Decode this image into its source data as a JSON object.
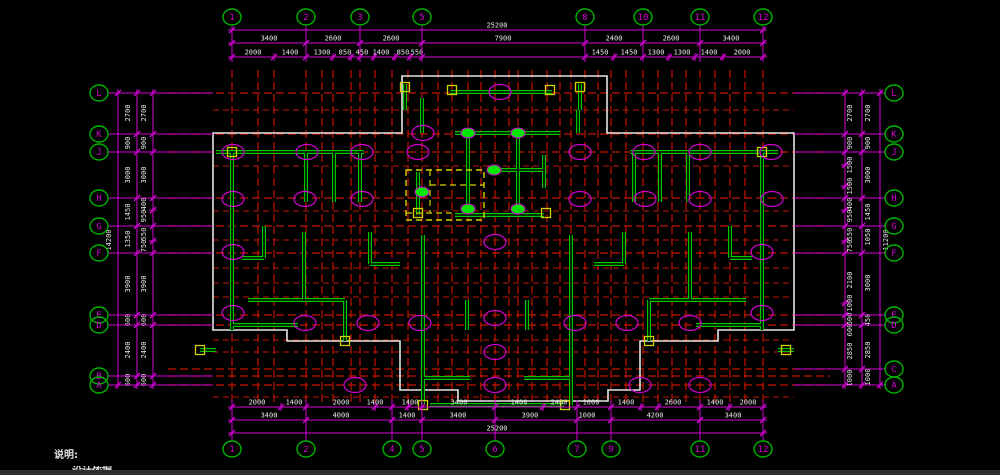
{
  "meta": {
    "app_area": "cad-structural-plan-viewport",
    "background": "#000000",
    "statusbar_color": "#2e2e2e"
  },
  "colors": {
    "grid_red": "#c21500",
    "dim_magenta": "#d400d4",
    "bubble_green": "#00b400",
    "bubble_text": "#d400d4",
    "wall_green": "#00c800",
    "outline_white": "#e6e6e6",
    "yellow": "#d2d200",
    "dot_green": "#00e600",
    "dim_text": "#e8e8e8"
  },
  "notes": {
    "title": "说明:",
    "line2": "设计依据"
  },
  "bubbles": {
    "top_y": 17,
    "bottom_y": 449,
    "left_x": 99,
    "right_x": 894,
    "top": [
      {
        "label": "1",
        "x": 232
      },
      {
        "label": "2",
        "x": 306
      },
      {
        "label": "3",
        "x": 360
      },
      {
        "label": "5",
        "x": 422
      },
      {
        "label": "8",
        "x": 585
      },
      {
        "label": "10",
        "x": 643
      },
      {
        "label": "11",
        "x": 700
      },
      {
        "label": "12",
        "x": 763
      }
    ],
    "bottom": [
      {
        "label": "1",
        "x": 232
      },
      {
        "label": "2",
        "x": 306
      },
      {
        "label": "4",
        "x": 392
      },
      {
        "label": "5",
        "x": 422
      },
      {
        "label": "6",
        "x": 495
      },
      {
        "label": "7",
        "x": 577
      },
      {
        "label": "9",
        "x": 611
      },
      {
        "label": "11",
        "x": 700
      },
      {
        "label": "12",
        "x": 763
      }
    ],
    "left": [
      {
        "label": "L",
        "y": 93
      },
      {
        "label": "K",
        "y": 134
      },
      {
        "label": "J",
        "y": 152
      },
      {
        "label": "H",
        "y": 198
      },
      {
        "label": "G",
        "y": 226
      },
      {
        "label": "F",
        "y": 253
      },
      {
        "label": "E",
        "y": 315
      },
      {
        "label": "D",
        "y": 325
      },
      {
        "label": "B",
        "y": 376
      },
      {
        "label": "A",
        "y": 385
      }
    ],
    "right": [
      {
        "label": "L",
        "y": 93
      },
      {
        "label": "K",
        "y": 134
      },
      {
        "label": "J",
        "y": 152
      },
      {
        "label": "H",
        "y": 198
      },
      {
        "label": "G",
        "y": 226
      },
      {
        "label": "F",
        "y": 253
      },
      {
        "label": "E",
        "y": 315
      },
      {
        "label": "D",
        "y": 325
      },
      {
        "label": "C",
        "y": 369
      },
      {
        "label": "A",
        "y": 385
      }
    ]
  },
  "dims": {
    "top_rows": [
      {
        "y": 30,
        "x1": 232,
        "x2": 763,
        "ticks": [
          232,
          763
        ],
        "labels": [
          [
            "25200",
            497
          ]
        ]
      },
      {
        "y": 43,
        "x1": 232,
        "x2": 763,
        "ticks": [
          232,
          306,
          360,
          422,
          585,
          643,
          700,
          763
        ],
        "labels": [
          [
            "3400",
            269
          ],
          [
            "2600",
            333
          ],
          [
            "2600",
            391
          ],
          [
            "7900",
            503
          ],
          [
            "2400",
            614
          ],
          [
            "2600",
            671
          ],
          [
            "3400",
            731
          ]
        ]
      },
      {
        "y": 57,
        "x1": 232,
        "x2": 763,
        "ticks": [
          232,
          274,
          306,
          333,
          351,
          360,
          374,
          395,
          410,
          422,
          585,
          614,
          643,
          669,
          695,
          723,
          763
        ],
        "labels": [
          [
            "2000",
            253
          ],
          [
            "1400",
            290
          ],
          [
            "1300",
            322
          ],
          [
            "850",
            345
          ],
          [
            "450",
            362
          ],
          [
            "1400",
            381
          ],
          [
            "850",
            403
          ],
          [
            "550",
            417
          ],
          [
            "1450",
            600
          ],
          [
            "1450",
            629
          ],
          [
            "1300",
            656
          ],
          [
            "1300",
            682
          ],
          [
            "1400",
            709
          ],
          [
            "2000",
            742
          ]
        ]
      }
    ],
    "bottom_rows": [
      {
        "y": 407,
        "x1": 232,
        "x2": 763,
        "ticks": [
          232,
          281,
          306,
          375,
          392,
          408,
          422,
          495,
          543,
          577,
          611,
          641,
          658,
          700,
          729,
          763
        ],
        "labels": [
          [
            "2000",
            257
          ],
          [
            "1400",
            294
          ],
          [
            "2000",
            341
          ],
          [
            "1400",
            375
          ],
          [
            "1400",
            410
          ],
          [
            "3400",
            459
          ],
          [
            "1400",
            519
          ],
          [
            "2400",
            559
          ],
          [
            "1000",
            591
          ],
          [
            "1400",
            626
          ],
          [
            "2600",
            673
          ],
          [
            "1400",
            715
          ],
          [
            "2000",
            748
          ]
        ]
      },
      {
        "y": 420,
        "x1": 232,
        "x2": 763,
        "ticks": [
          232,
          306,
          392,
          422,
          495,
          577,
          611,
          700,
          763
        ],
        "labels": [
          [
            "3400",
            269
          ],
          [
            "4000",
            341
          ],
          [
            "1400",
            407
          ],
          [
            "3400",
            458
          ],
          [
            "3900",
            530
          ],
          [
            "1000",
            587
          ],
          [
            "4200",
            655
          ],
          [
            "3400",
            733
          ]
        ]
      },
      {
        "y": 433,
        "x1": 232,
        "x2": 763,
        "ticks": [
          232,
          763
        ],
        "labels": [
          [
            "25200",
            497
          ]
        ]
      }
    ],
    "left_cols": [
      {
        "x": 118,
        "y1": 93,
        "y2": 385,
        "tx": 111,
        "ticks": [
          93,
          385
        ],
        "labels": [
          [
            "14200",
            240
          ]
        ]
      },
      {
        "x": 137,
        "y1": 93,
        "y2": 385,
        "tx": 130,
        "ticks": [
          93,
          134,
          152,
          198,
          226,
          253,
          315,
          325,
          376,
          385
        ],
        "labels": [
          [
            "2700",
            113
          ],
          [
            "900",
            143
          ],
          [
            "3000",
            175
          ],
          [
            "1450",
            212
          ],
          [
            "1350",
            239
          ],
          [
            "3900",
            284
          ],
          [
            "600",
            320
          ],
          [
            "2400",
            350
          ],
          [
            "600",
            380
          ]
        ]
      },
      {
        "x": 153,
        "y1": 93,
        "y2": 385,
        "tx": 146,
        "ticks": [
          93,
          134,
          152,
          198,
          210,
          226,
          241,
          253,
          315,
          325,
          376,
          385
        ],
        "labels": [
          [
            "2700",
            113
          ],
          [
            "900",
            143
          ],
          [
            "3000",
            175
          ],
          [
            "400",
            204
          ],
          [
            "950",
            216
          ],
          [
            "550",
            234
          ],
          [
            "750",
            246
          ],
          [
            "3900",
            284
          ],
          [
            "600",
            320
          ],
          [
            "2400",
            350
          ],
          [
            "600",
            380
          ]
        ]
      }
    ],
    "right_cols": [
      {
        "x": 880,
        "y1": 93,
        "y2": 385,
        "tx": 888,
        "ticks": [
          93,
          385
        ],
        "labels": [
          [
            "11200",
            240
          ]
        ]
      },
      {
        "x": 862,
        "y1": 93,
        "y2": 385,
        "tx": 870,
        "ticks": [
          93,
          134,
          152,
          198,
          226,
          253,
          315,
          325,
          369,
          385
        ],
        "labels": [
          [
            "2700",
            113
          ],
          [
            "900",
            143
          ],
          [
            "3000",
            175
          ],
          [
            "1450",
            212
          ],
          [
            "1050",
            237
          ],
          [
            "3000",
            283
          ],
          [
            "450",
            320
          ],
          [
            "2850",
            350
          ],
          [
            "1000",
            377
          ]
        ]
      },
      {
        "x": 845,
        "y1": 93,
        "y2": 385,
        "tx": 852,
        "ticks": [
          93,
          134,
          152,
          165,
          186,
          198,
          210,
          226,
          241,
          253,
          303,
          315,
          325,
          369,
          385
        ],
        "labels": [
          [
            "2700",
            113
          ],
          [
            "900",
            143
          ],
          [
            "1500",
            165
          ],
          [
            "1500",
            186
          ],
          [
            "400",
            204
          ],
          [
            "950",
            216
          ],
          [
            "550",
            234
          ],
          [
            "750",
            246
          ],
          [
            "2100",
            280
          ],
          [
            "1000",
            303
          ],
          [
            "600",
            319
          ],
          [
            "600",
            330
          ],
          [
            "2850",
            351
          ],
          [
            "1000",
            378
          ]
        ]
      }
    ],
    "top_ext": {
      "y1": 26,
      "y2": 62
    },
    "bottom_ext": {
      "y1": 400,
      "y2": 441
    },
    "left_ext": {
      "x1": 108,
      "x2": 213
    },
    "right_ext": {
      "x1": 794,
      "x2": 886
    }
  },
  "grid": {
    "red_v": {
      "y1": 70,
      "y2": 405,
      "xs": [
        232,
        258,
        274,
        306,
        322,
        333,
        351,
        360,
        375,
        392,
        408,
        422,
        438,
        452,
        468,
        481,
        495,
        509,
        518,
        532,
        547,
        560,
        571,
        585,
        598,
        611,
        626,
        643,
        658,
        672,
        686,
        700,
        715,
        730,
        745,
        763
      ]
    },
    "red_h_main": {
      "x1": 168,
      "x2": 830,
      "ys": [
        93,
        134,
        152,
        198,
        226,
        253,
        315,
        325,
        369,
        376,
        385
      ]
    },
    "red_h_sub": {
      "x1": 213,
      "x2": 794,
      "ys": [
        110,
        166,
        211,
        240,
        268,
        283,
        297,
        340,
        352,
        397
      ]
    }
  },
  "plan": {
    "outline": [
      [
        213,
        133
      ],
      [
        402,
        133
      ],
      [
        402,
        76
      ],
      [
        607,
        76
      ],
      [
        607,
        133
      ],
      [
        794,
        133
      ],
      [
        794,
        330
      ],
      [
        718,
        330
      ],
      [
        718,
        341
      ],
      [
        640,
        341
      ],
      [
        640,
        390
      ],
      [
        608,
        390
      ],
      [
        608,
        401
      ],
      [
        458,
        401
      ],
      [
        458,
        390
      ],
      [
        400,
        390
      ],
      [
        400,
        341
      ],
      [
        287,
        341
      ],
      [
        287,
        330
      ],
      [
        213,
        330
      ]
    ],
    "walls": [
      [
        450,
        92,
        552,
        92
      ],
      [
        405,
        84,
        405,
        110
      ],
      [
        580,
        84,
        580,
        110
      ],
      [
        422,
        98,
        422,
        133
      ],
      [
        578,
        110,
        578,
        133
      ],
      [
        455,
        133,
        560,
        133
      ],
      [
        468,
        133,
        468,
        215
      ],
      [
        518,
        133,
        518,
        215
      ],
      [
        490,
        170,
        544,
        170
      ],
      [
        544,
        155,
        544,
        188
      ],
      [
        455,
        215,
        544,
        215
      ],
      [
        418,
        172,
        418,
        215
      ],
      [
        216,
        152,
        364,
        152
      ],
      [
        232,
        152,
        232,
        330
      ],
      [
        306,
        152,
        306,
        202
      ],
      [
        334,
        152,
        334,
        202
      ],
      [
        360,
        152,
        360,
        202
      ],
      [
        264,
        226,
        264,
        258
      ],
      [
        242,
        258,
        264,
        258
      ],
      [
        304,
        232,
        304,
        300
      ],
      [
        248,
        300,
        345,
        300
      ],
      [
        345,
        300,
        345,
        341
      ],
      [
        232,
        325,
        298,
        325
      ],
      [
        200,
        350,
        216,
        350
      ],
      [
        370,
        232,
        370,
        264
      ],
      [
        370,
        264,
        400,
        264
      ],
      [
        423,
        235,
        423,
        405
      ],
      [
        571,
        235,
        571,
        405
      ],
      [
        430,
        405,
        564,
        405
      ],
      [
        423,
        378,
        470,
        378
      ],
      [
        524,
        378,
        571,
        378
      ],
      [
        467,
        300,
        467,
        330
      ],
      [
        527,
        300,
        527,
        330
      ],
      [
        630,
        152,
        778,
        152
      ],
      [
        762,
        152,
        762,
        330
      ],
      [
        688,
        152,
        688,
        202
      ],
      [
        660,
        152,
        660,
        202
      ],
      [
        634,
        152,
        634,
        202
      ],
      [
        730,
        226,
        730,
        258
      ],
      [
        730,
        258,
        752,
        258
      ],
      [
        690,
        232,
        690,
        300
      ],
      [
        649,
        300,
        746,
        300
      ],
      [
        649,
        300,
        649,
        341
      ],
      [
        696,
        325,
        762,
        325
      ],
      [
        778,
        350,
        794,
        350
      ],
      [
        624,
        232,
        624,
        264
      ],
      [
        594,
        264,
        624,
        264
      ]
    ],
    "yellow_columns": [
      [
        405,
        87
      ],
      [
        580,
        87
      ],
      [
        452,
        90
      ],
      [
        550,
        90
      ],
      [
        418,
        213
      ],
      [
        546,
        213
      ],
      [
        232,
        152
      ],
      [
        762,
        152
      ],
      [
        345,
        341
      ],
      [
        649,
        341
      ],
      [
        200,
        350
      ],
      [
        786,
        350
      ],
      [
        423,
        405
      ],
      [
        565,
        405
      ]
    ],
    "green_dots": [
      [
        468,
        133
      ],
      [
        518,
        133
      ],
      [
        494,
        170
      ],
      [
        468,
        209
      ],
      [
        518,
        209
      ],
      [
        422,
        192
      ]
    ],
    "magenta_ellipses": [
      [
        500,
        92
      ],
      [
        423,
        133
      ],
      [
        233,
        152
      ],
      [
        307,
        152
      ],
      [
        362,
        152
      ],
      [
        418,
        152
      ],
      [
        580,
        152
      ],
      [
        644,
        152
      ],
      [
        700,
        152
      ],
      [
        771,
        152
      ],
      [
        233,
        199
      ],
      [
        305,
        199
      ],
      [
        362,
        199
      ],
      [
        580,
        199
      ],
      [
        645,
        199
      ],
      [
        700,
        199
      ],
      [
        772,
        199
      ],
      [
        233,
        252
      ],
      [
        762,
        252
      ],
      [
        495,
        242
      ],
      [
        495,
        318
      ],
      [
        495,
        352
      ],
      [
        233,
        313
      ],
      [
        305,
        323
      ],
      [
        368,
        323
      ],
      [
        420,
        323
      ],
      [
        575,
        323
      ],
      [
        627,
        323
      ],
      [
        690,
        323
      ],
      [
        762,
        313
      ],
      [
        355,
        385
      ],
      [
        495,
        385
      ],
      [
        640,
        385
      ],
      [
        700,
        385
      ]
    ],
    "dashed_box": {
      "x": 406,
      "y": 170,
      "w": 78,
      "h": 50
    },
    "dashed_inner": [
      [
        430,
        185,
        484,
        185
      ],
      [
        406,
        213,
        455,
        213
      ],
      [
        430,
        170,
        430,
        213
      ]
    ]
  }
}
